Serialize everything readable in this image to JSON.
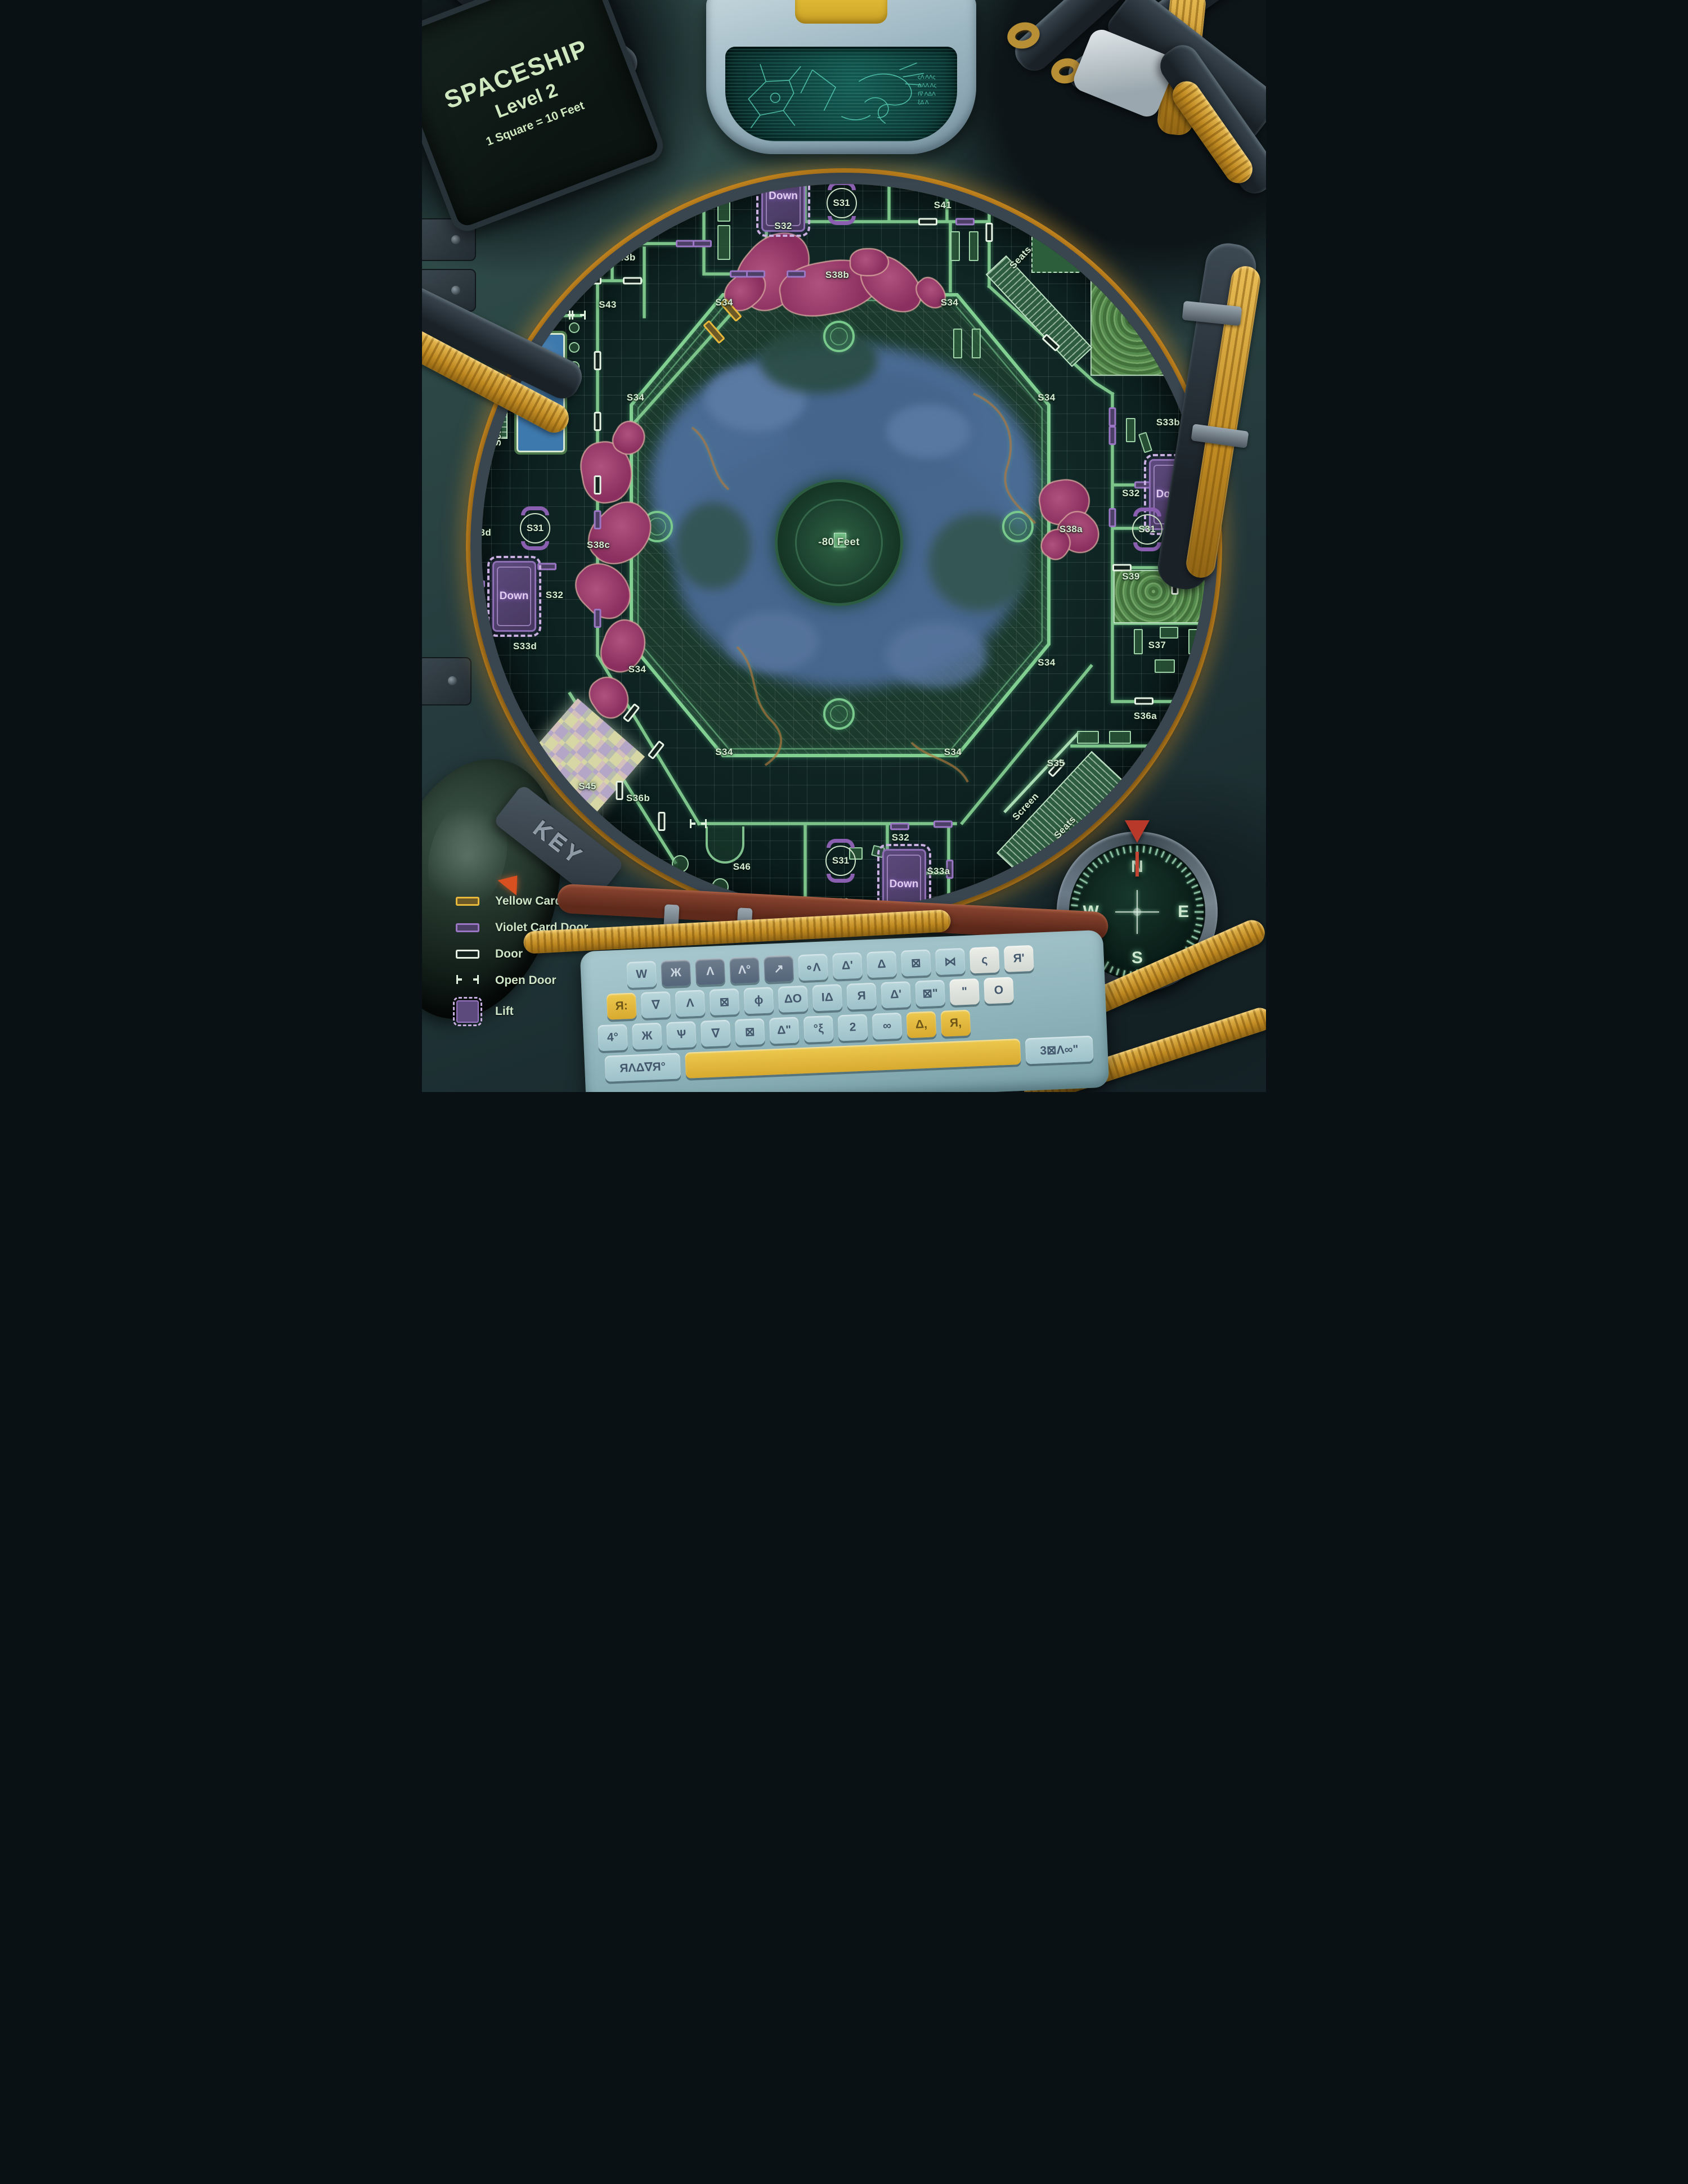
{
  "title": {
    "line1": "SPACESHIP",
    "line2": "Level 2",
    "line3": "1 Square = 10 Feet"
  },
  "key_tag": "KEY",
  "legend": {
    "items": [
      {
        "type": "yellow-card-door",
        "label": "Yellow Card Door"
      },
      {
        "type": "violet-card-door",
        "label": "Violet Card Door"
      },
      {
        "type": "door",
        "label": "Door"
      },
      {
        "type": "open-door",
        "label": "Open Door"
      },
      {
        "type": "lift",
        "label": "Lift"
      }
    ]
  },
  "compass": {
    "north": "N",
    "east": "E",
    "south": "S",
    "west": "W"
  },
  "map": {
    "center_depth": "-80 Feet",
    "room_labels": [
      {
        "text": "S33b",
        "x": 50.9,
        "y": 13.5
      },
      {
        "text": "S41a",
        "x": 60.0,
        "y": 13.7
      },
      {
        "text": "S41b",
        "x": 64.3,
        "y": 13.7
      },
      {
        "text": "S40",
        "x": 70.4,
        "y": 17.8
      },
      {
        "text": "S33c",
        "x": 37.8,
        "y": 16.8
      },
      {
        "text": "S42",
        "x": 29.3,
        "y": 19.9
      },
      {
        "text": "S32",
        "x": 42.8,
        "y": 20.7
      },
      {
        "text": "S41",
        "x": 61.7,
        "y": 18.8
      },
      {
        "text": "S39",
        "x": 84.7,
        "y": 29.3
      },
      {
        "text": "S43a",
        "x": 20.0,
        "y": 23.6
      },
      {
        "text": "S43b",
        "x": 23.9,
        "y": 23.6
      },
      {
        "text": "S44b",
        "x": 16.4,
        "y": 25.2
      },
      {
        "text": "S43",
        "x": 22.0,
        "y": 27.9
      },
      {
        "text": "S44a",
        "x": 14.1,
        "y": 28.7
      },
      {
        "text": "S44",
        "x": 13.5,
        "y": 30.9
      },
      {
        "text": "S38b",
        "x": 49.2,
        "y": 25.2
      },
      {
        "text": "S34",
        "x": 35.8,
        "y": 27.7
      },
      {
        "text": "S34",
        "x": 62.5,
        "y": 27.7
      },
      {
        "text": "S34",
        "x": 25.3,
        "y": 36.4
      },
      {
        "text": "S34",
        "x": 74.0,
        "y": 36.4
      },
      {
        "text": "S34",
        "x": 25.5,
        "y": 61.3
      },
      {
        "text": "S34",
        "x": 74.0,
        "y": 60.7
      },
      {
        "text": "S34",
        "x": 35.8,
        "y": 68.9
      },
      {
        "text": "S34",
        "x": 62.9,
        "y": 68.9
      },
      {
        "text": "S33d",
        "x": 6.8,
        "y": 48.8
      },
      {
        "text": "S38c",
        "x": 20.9,
        "y": 49.9
      },
      {
        "text": "S33b",
        "x": 88.4,
        "y": 38.7
      },
      {
        "text": "S32",
        "x": 84.0,
        "y": 45.2
      },
      {
        "text": "S33b",
        "x": 93.3,
        "y": 49.0
      },
      {
        "text": "S38a",
        "x": 76.9,
        "y": 48.5
      },
      {
        "text": "S39",
        "x": 84.0,
        "y": 52.8
      },
      {
        "text": "S39",
        "x": 91.9,
        "y": 52.8
      },
      {
        "text": "S37",
        "x": 87.1,
        "y": 59.1
      },
      {
        "text": "S32",
        "x": 15.7,
        "y": 54.5
      },
      {
        "text": "S33d",
        "x": 12.2,
        "y": 59.2
      },
      {
        "text": "S36a",
        "x": 85.7,
        "y": 65.6
      },
      {
        "text": "S35",
        "x": 75.1,
        "y": 69.9
      },
      {
        "text": "S45",
        "x": 19.6,
        "y": 72.0
      },
      {
        "text": "S36b",
        "x": 25.6,
        "y": 73.1
      },
      {
        "text": "S46",
        "x": 37.9,
        "y": 79.4
      },
      {
        "text": "S32",
        "x": 56.7,
        "y": 76.7
      },
      {
        "text": "S33a",
        "x": 61.2,
        "y": 79.8
      },
      {
        "text": "S33a",
        "x": 49.9,
        "y": 82.6
      },
      {
        "text": "-80 Feet",
        "x": 49.4,
        "y": 49.6,
        "size": 1.1
      },
      {
        "text": "Seats",
        "x": 9.0,
        "y": 39.6,
        "rot": -90
      },
      {
        "text": "Seats",
        "x": 70.9,
        "y": 23.6,
        "rot": -47
      },
      {
        "text": "Ring",
        "x": 76.0,
        "y": 22.0,
        "rot": -45
      },
      {
        "text": "Screen",
        "x": 71.5,
        "y": 73.9,
        "rot": -47
      },
      {
        "text": "Seats",
        "x": 76.2,
        "y": 75.8,
        "rot": -47
      }
    ],
    "lifts": [
      {
        "label": "Down",
        "x": 42.8,
        "y": 18.0
      },
      {
        "label": "Down",
        "x": 88.7,
        "y": 45.3
      },
      {
        "label": "Down",
        "x": 10.9,
        "y": 54.6
      },
      {
        "label": "Down",
        "x": 57.1,
        "y": 81.0
      }
    ],
    "s31_nodes": [
      {
        "label": "S31",
        "x": 49.7,
        "y": 18.6
      },
      {
        "label": "S31",
        "x": 13.4,
        "y": 48.4
      },
      {
        "label": "S31",
        "x": 85.9,
        "y": 48.5
      },
      {
        "label": "S31",
        "x": 49.6,
        "y": 78.8
      }
    ],
    "doors": {
      "violet": [
        {
          "x": 45.4,
          "y": 13.5,
          "o": "v"
        },
        {
          "x": 55.3,
          "y": 11.2,
          "o": "v"
        },
        {
          "x": 20.6,
          "y": 16.8,
          "o": "v"
        },
        {
          "x": 31.2,
          "y": 22.3
        },
        {
          "x": 33.2,
          "y": 22.3
        },
        {
          "x": 37.6,
          "y": 25.1
        },
        {
          "x": 39.5,
          "y": 25.1
        },
        {
          "x": 44.3,
          "y": 25.1
        },
        {
          "x": 64.3,
          "y": 20.3
        },
        {
          "x": 20.8,
          "y": 47.6,
          "o": "v"
        },
        {
          "x": 20.8,
          "y": 56.6,
          "o": "v"
        },
        {
          "x": 14.8,
          "y": 51.9
        },
        {
          "x": 6.3,
          "y": 53.5
        },
        {
          "x": 81.8,
          "y": 38.2,
          "o": "v"
        },
        {
          "x": 81.8,
          "y": 39.9,
          "o": "v"
        },
        {
          "x": 81.8,
          "y": 47.4,
          "o": "v"
        },
        {
          "x": 85.5,
          "y": 44.4
        },
        {
          "x": 92.9,
          "y": 48.4
        },
        {
          "x": 87.8,
          "y": 68.3
        },
        {
          "x": 56.6,
          "y": 75.7
        },
        {
          "x": 61.7,
          "y": 75.5
        },
        {
          "x": 62.5,
          "y": 79.6,
          "o": "v"
        }
      ],
      "plain": [
        {
          "x": 49.3,
          "y": 13.0
        },
        {
          "x": 59.9,
          "y": 20.3
        },
        {
          "x": 67.2,
          "y": 21.3,
          "o": "v"
        },
        {
          "x": 74.4,
          "y": 16.2,
          "o": "v"
        },
        {
          "x": 79.2,
          "y": 12.6
        },
        {
          "x": 17.6,
          "y": 25.7
        },
        {
          "x": 20.1,
          "y": 25.7
        },
        {
          "x": 24.9,
          "y": 25.7
        },
        {
          "x": 20.8,
          "y": 33.0,
          "o": "v"
        },
        {
          "x": 20.8,
          "y": 38.6,
          "o": "v"
        },
        {
          "x": 20.8,
          "y": 44.4,
          "o": "v"
        },
        {
          "x": 74.5,
          "y": 31.4,
          "rot": 43
        },
        {
          "x": 82.9,
          "y": 52.0
        },
        {
          "x": 89.2,
          "y": 53.6,
          "o": "v"
        },
        {
          "x": 85.5,
          "y": 64.2
        },
        {
          "x": 75.2,
          "y": 70.3,
          "rot": -47
        },
        {
          "x": 24.8,
          "y": 65.3,
          "rot": -52
        },
        {
          "x": 27.7,
          "y": 68.7,
          "rot": -52
        },
        {
          "x": 23.4,
          "y": 72.4,
          "o": "v"
        },
        {
          "x": 28.4,
          "y": 75.2,
          "o": "v"
        }
      ],
      "yellow": [
        {
          "x": 34.6,
          "y": 30.4,
          "rot": 49
        },
        {
          "x": 36.6,
          "y": 28.4,
          "rot": 49
        }
      ],
      "open": [
        {
          "x": 16.9,
          "y": 28.85
        },
        {
          "x": 18.4,
          "y": 28.85
        },
        {
          "x": 32.7,
          "y": 75.4
        }
      ]
    }
  },
  "keyboard": {
    "rows": [
      [
        {
          "g": "W",
          "c": "b"
        },
        {
          "g": "Ж",
          "c": "d"
        },
        {
          "g": "Λ",
          "c": "d"
        },
        {
          "g": "Λ°",
          "c": "d"
        },
        {
          "g": "↗",
          "c": "d"
        },
        {
          "g": "∘Λ",
          "c": "b"
        },
        {
          "g": "Δ'",
          "c": "b"
        },
        {
          "g": "Δ",
          "c": "b"
        },
        {
          "g": "⊠",
          "c": "b"
        },
        {
          "g": "⋈",
          "c": "b"
        },
        {
          "g": "ς",
          "c": "w"
        },
        {
          "g": "Я'",
          "c": "w"
        }
      ],
      [
        {
          "g": "Я:",
          "c": "y"
        },
        {
          "g": "∇",
          "c": "b"
        },
        {
          "g": "Λ",
          "c": "b"
        },
        {
          "g": "⊠",
          "c": "b"
        },
        {
          "g": "ϕ",
          "c": "b"
        },
        {
          "g": "ΔO",
          "c": "b"
        },
        {
          "g": "ΙΔ",
          "c": "b"
        },
        {
          "g": "Я",
          "c": "b"
        },
        {
          "g": "Δ'",
          "c": "b"
        },
        {
          "g": "⊠\"",
          "c": "b"
        },
        {
          "g": "\"",
          "c": "w"
        },
        {
          "g": "O",
          "c": "w"
        }
      ],
      [
        {
          "g": "4°",
          "c": "b"
        },
        {
          "g": "Ж",
          "c": "b"
        },
        {
          "g": "Ѱ",
          "c": "b"
        },
        {
          "g": "∇",
          "c": "b"
        },
        {
          "g": "⊠",
          "c": "b"
        },
        {
          "g": "Δ\"",
          "c": "b"
        },
        {
          "g": "°ξ",
          "c": "b"
        },
        {
          "g": "2",
          "c": "b"
        },
        {
          "g": "∞",
          "c": "b"
        },
        {
          "g": "Δ,",
          "c": "y"
        },
        {
          "g": "Я,",
          "c": "y"
        }
      ],
      [
        {
          "g": "ЯΛΔ∇Я°",
          "c": "b",
          "wide": true
        },
        {
          "g": "",
          "c": "y",
          "space": true
        },
        {
          "g": "3⊠Λ∞\"",
          "c": "b",
          "wide": true
        }
      ]
    ]
  },
  "visor_glyphs": "ςΛ ΛΛς\nΔΛΛ Λς\nΙ∇ ΛΔΛ\nξΔ Λ",
  "colors": {
    "wall_green": "#7cc489",
    "violet_door": "#9a76c4",
    "yellow_door": "#e8b83a",
    "plain_door": "#e6f2e4",
    "label_green": "#d8edd3",
    "growth_magenta": "#8a2f5f",
    "lake_blue": "#4a6b94",
    "rim_orange": "#c9881f"
  }
}
